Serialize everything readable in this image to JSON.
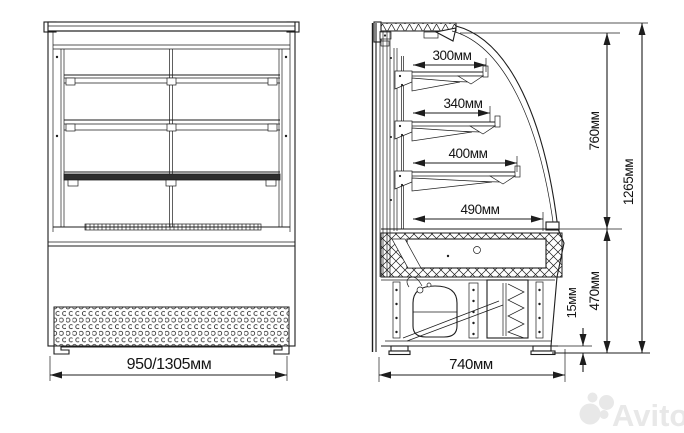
{
  "drawing": {
    "kind": "technical dimension drawing",
    "views": {
      "front_view": {
        "width_label": "950/1305мм"
      },
      "side_view": {
        "shelf_depth_labels": [
          "300мм",
          "340мм",
          "400мм",
          "490мм"
        ],
        "inner_height_label": "760мм",
        "total_height_label": "1265мм",
        "base_height_label": "470мм",
        "foot_height_label": "15мм",
        "depth_label": "740мм"
      }
    },
    "dimensions_mm": {
      "front_width": "950/1305",
      "shelf_depths": [
        300,
        340,
        400,
        490
      ],
      "glass_section_height": 760,
      "total_height": 1265,
      "base_section_height": 470,
      "foot_height": 15,
      "base_depth": 740
    },
    "colors": {
      "line": "#1d1d1d",
      "background": "#ffffff"
    }
  },
  "watermark": {
    "text": "Avito",
    "color": "#e8e8e8"
  }
}
